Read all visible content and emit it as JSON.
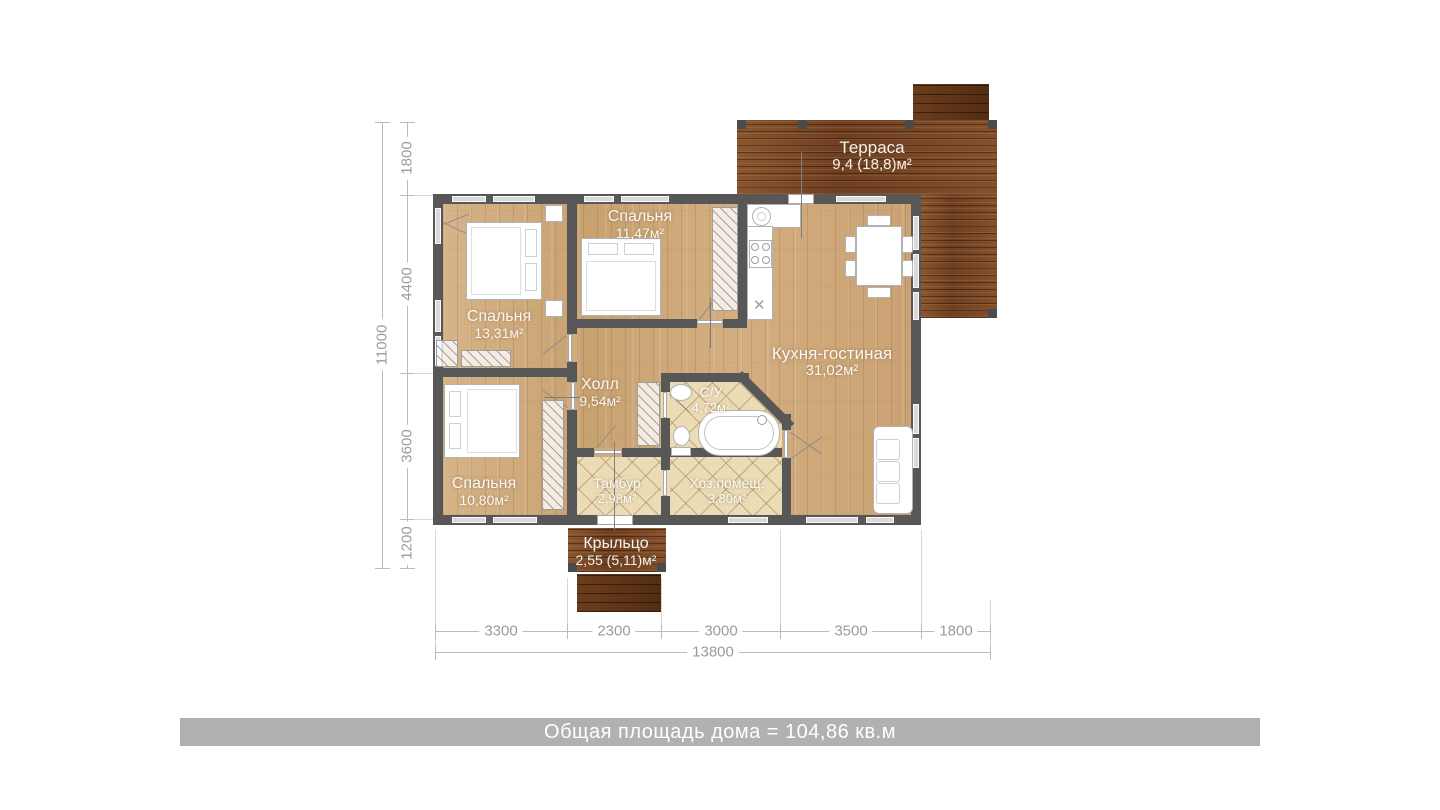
{
  "rooms": {
    "terrace": {
      "name": "Терраса",
      "area": "9,4 (18,8)м²"
    },
    "bedroom_top_middle": {
      "name": "Спальня",
      "area": "11,47м²"
    },
    "bedroom_top_left": {
      "name": "Спальня",
      "area": "13,31м²"
    },
    "bedroom_bottom_left": {
      "name": "Спальня",
      "area": "10,80м²"
    },
    "kitchen_living": {
      "name": "Кухня-гостиная",
      "area": "31,02м²"
    },
    "hall": {
      "name": "Холл",
      "area": "9,54м²"
    },
    "bathroom": {
      "name": "С/У",
      "area": "4,72м²"
    },
    "tambour": {
      "name": "Тамбур",
      "area": "2,98м²"
    },
    "utility": {
      "name": "Хоз.помещ.",
      "area": "3,80м²"
    },
    "porch": {
      "name": "Крыльцо",
      "area": "2,55 (5,11)м²"
    }
  },
  "dimensions": {
    "left": {
      "segments": [
        "1800",
        "4400",
        "3600",
        "1200"
      ],
      "total": "11000"
    },
    "bottom": {
      "segments": [
        "3300",
        "2300",
        "3000",
        "3500",
        "1800"
      ],
      "total": "13800"
    }
  },
  "footer": {
    "text": "Общая площадь дома = 104,86 кв.м"
  },
  "colors": {
    "wall": "#575757",
    "wood_floor": "#cfab7e",
    "terrace_wood": "#7c4a28",
    "tile_floor": "#ecdcb6",
    "window": "#d9d9d9",
    "footer_bar": "#b1b1b1",
    "dimension_text": "#9b9b9b",
    "room_label": "#ffffff"
  }
}
